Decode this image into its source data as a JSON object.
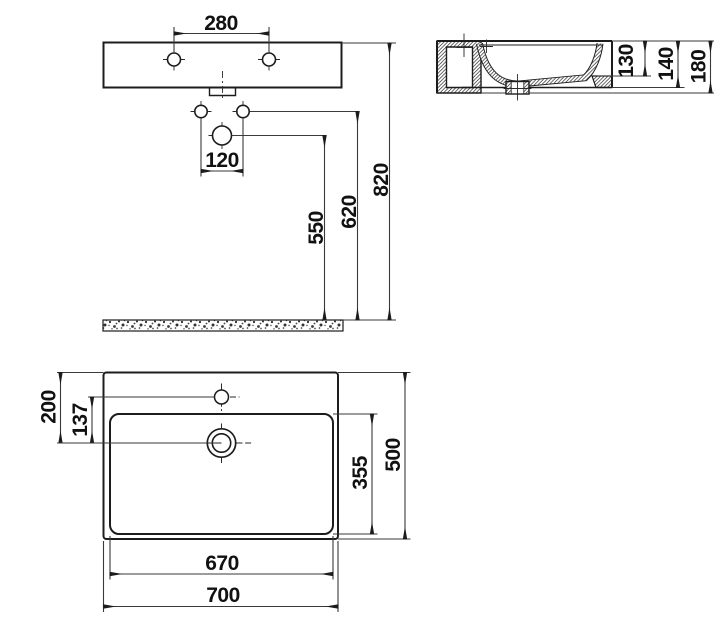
{
  "title": "Washbasin technical drawing - three orthographic views",
  "colors": {
    "background": "#ffffff",
    "object_line": "#1c1c1c",
    "dimension_line": "#3a3a3a",
    "text": "#111111"
  },
  "views": {
    "front_elevation": {
      "name": "front elevation with installation heights",
      "dims": {
        "tap_hole_spacing": "280",
        "fixing_hole_spacing": "120",
        "drain_height": "550",
        "fixing_height": "620",
        "rim_height": "820"
      }
    },
    "side_section": {
      "name": "side cross-section",
      "dims": {
        "bowl_inner_depth": "130",
        "front_edge_height": "140",
        "overall_height": "180"
      }
    },
    "plan_view": {
      "name": "plan view",
      "dims": {
        "back_to_drain": "200",
        "tap_to_drain": "137",
        "bowl_inner_depth": "355",
        "overall_depth": "500",
        "bowl_inner_width": "670",
        "overall_width": "700"
      }
    }
  }
}
